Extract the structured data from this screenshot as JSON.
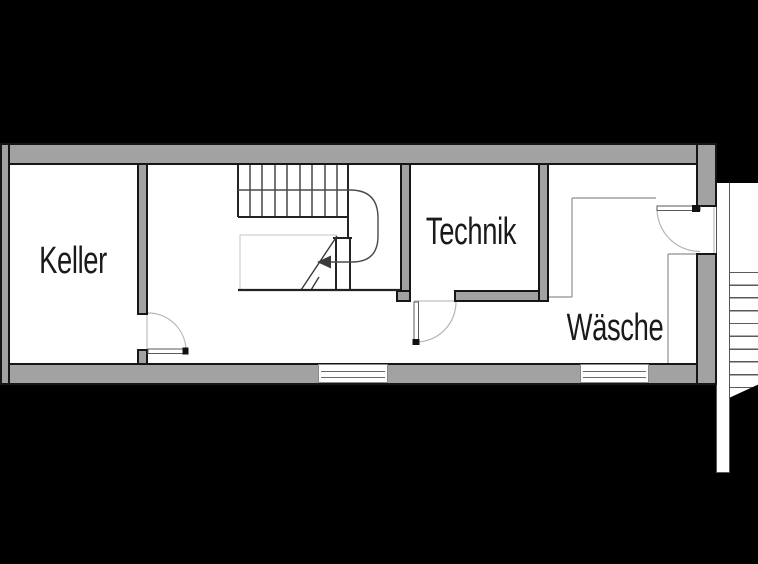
{
  "plan": {
    "type": "basement-floor-plan",
    "rooms": {
      "keller": {
        "label": "Keller"
      },
      "technik": {
        "label": "Technik"
      },
      "waesche": {
        "label": "Wäsche"
      }
    },
    "colors": {
      "background": "#000000",
      "wall_fill": "#a2a2a2",
      "wall_outline": "#161616",
      "room_fill": "#ffffff",
      "stair_line": "#3a3a3a",
      "door_arc": "#b5b5b5",
      "thin_line": "#8f8f8f"
    }
  }
}
